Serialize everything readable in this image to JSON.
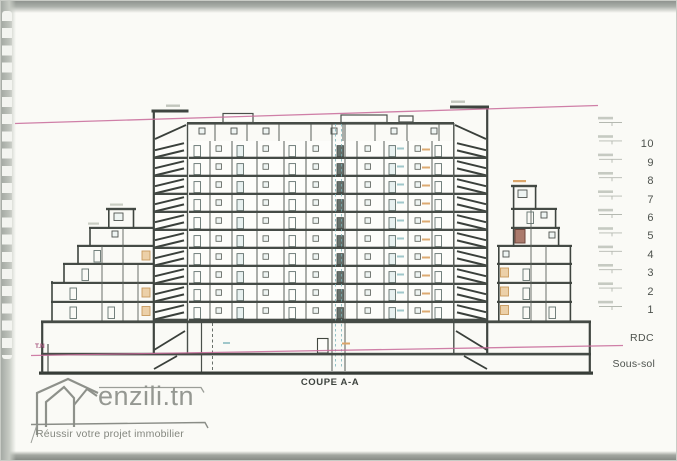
{
  "drawing": {
    "section_title": "COUPE A-A",
    "terrain_label": "T.N",
    "floors": [
      "10",
      "9",
      "8",
      "7",
      "6",
      "5",
      "4",
      "3",
      "2",
      "1"
    ],
    "ground_floor_label": "RDC",
    "basement_label": "Sous-sol"
  },
  "watermark": {
    "brand": "enzili.tn",
    "tagline": "Réussir votre projet immobilier"
  },
  "colors": {
    "paper": "#fafaf6",
    "ink": "#3f4540",
    "site_line_pink": "#c86a9a",
    "accent_teal": "#8fbdc2",
    "accent_tan": "#dba569",
    "watermark_gray": "#8e918b"
  }
}
